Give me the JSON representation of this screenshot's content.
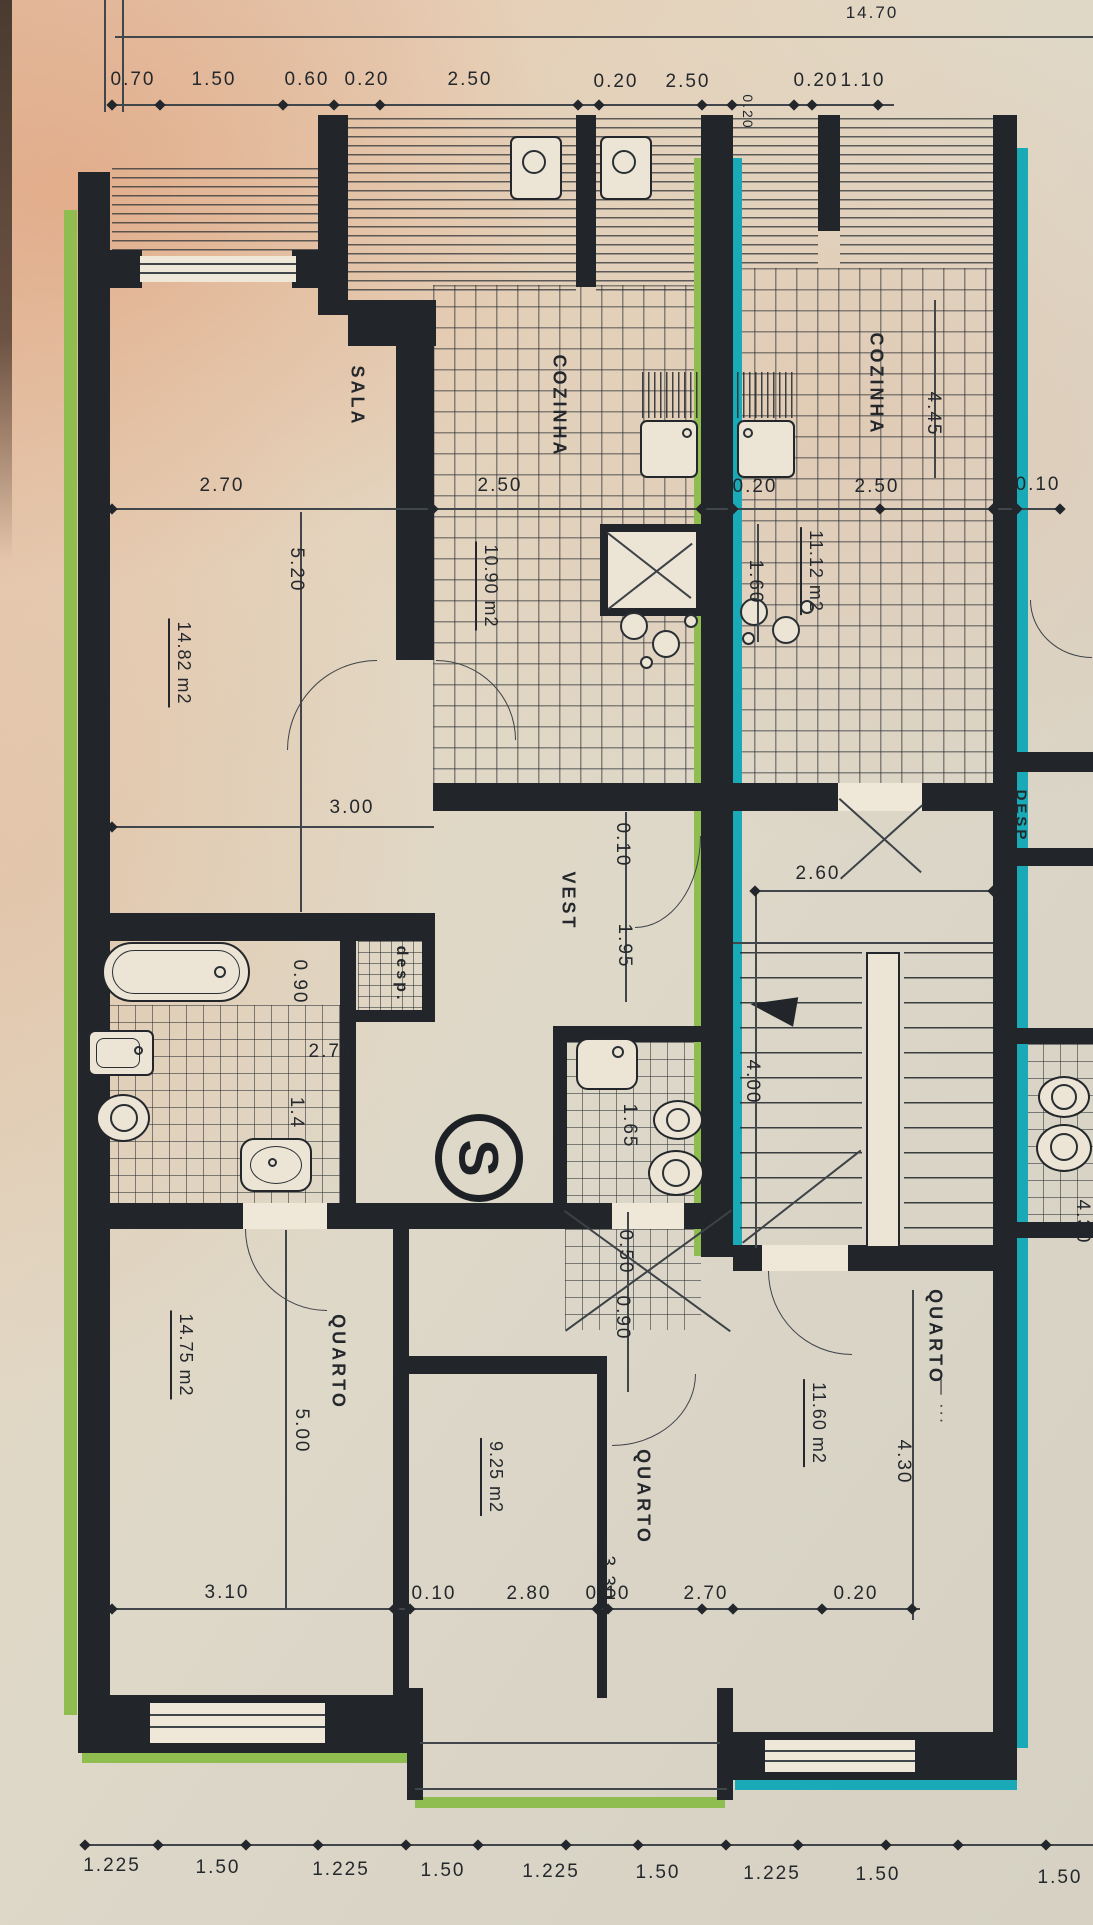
{
  "document": {
    "kind": "apartment floor plan",
    "language": "pt"
  },
  "colors": {
    "wall": "#22262a",
    "green_highlight": "#8fbd4f",
    "teal_highlight": "#1aa9b6",
    "paper_pink": "#e4c1a8",
    "paper_beige": "#ddd7c8",
    "ink": "#24282c"
  },
  "section_marker": "S",
  "labels": {
    "dimensions": [
      {
        "t": "14.70",
        "x": 872,
        "y": 13,
        "r": 0,
        "s": 17
      },
      {
        "t": "0.70",
        "x": 133,
        "y": 80,
        "r": 0
      },
      {
        "t": "1.50",
        "x": 214,
        "y": 80,
        "r": 0
      },
      {
        "t": "0.60",
        "x": 307,
        "y": 80,
        "r": 0
      },
      {
        "t": "0.20",
        "x": 367,
        "y": 80,
        "r": 0
      },
      {
        "t": "2.50",
        "x": 470,
        "y": 80,
        "r": 0
      },
      {
        "t": "0.20",
        "x": 616,
        "y": 82,
        "r": 0
      },
      {
        "t": "2.50",
        "x": 688,
        "y": 82,
        "r": 0
      },
      {
        "t": "0.20",
        "x": 816,
        "y": 81,
        "r": 0
      },
      {
        "t": "1.10",
        "x": 863,
        "y": 81,
        "r": 0
      },
      {
        "t": "0.20",
        "x": 748,
        "y": 112,
        "r": 90,
        "s": 14
      },
      {
        "t": "2.70",
        "x": 222,
        "y": 486,
        "r": 0
      },
      {
        "t": "2.50",
        "x": 500,
        "y": 486,
        "r": 0
      },
      {
        "t": "0.20",
        "x": 755,
        "y": 487,
        "r": 0
      },
      {
        "t": "2.50",
        "x": 877,
        "y": 487,
        "r": 0
      },
      {
        "t": "0.10",
        "x": 1038,
        "y": 485,
        "r": 0
      },
      {
        "t": "5.20",
        "x": 296,
        "y": 570,
        "r": 90
      },
      {
        "t": "4.45",
        "x": 933,
        "y": 414,
        "r": 90
      },
      {
        "t": "1.60",
        "x": 755,
        "y": 582,
        "r": 90
      },
      {
        "t": "3.00",
        "x": 352,
        "y": 808,
        "r": 0
      },
      {
        "t": "0.10",
        "x": 622,
        "y": 845,
        "r": 90
      },
      {
        "t": "1.95",
        "x": 624,
        "y": 946,
        "r": 90
      },
      {
        "t": "2.60",
        "x": 818,
        "y": 874,
        "r": 0
      },
      {
        "t": "4.00",
        "x": 752,
        "y": 1082,
        "r": 90
      },
      {
        "t": "0.90",
        "x": 299,
        "y": 982,
        "r": 90
      },
      {
        "t": "2.75",
        "x": 331,
        "y": 1052,
        "r": 0
      },
      {
        "t": "1.4",
        "x": 296,
        "y": 1113,
        "r": 90
      },
      {
        "t": "1.65",
        "x": 629,
        "y": 1126,
        "r": 90
      },
      {
        "t": "0.50",
        "x": 625,
        "y": 1252,
        "r": 90
      },
      {
        "t": "0.90",
        "x": 622,
        "y": 1318,
        "r": 90
      },
      {
        "t": "5.00",
        "x": 301,
        "y": 1431,
        "r": 90
      },
      {
        "t": "3.30",
        "x": 607,
        "y": 1578,
        "r": 90
      },
      {
        "t": "4.30",
        "x": 903,
        "y": 1462,
        "r": 90
      },
      {
        "t": "4.30",
        "x": 1082,
        "y": 1222,
        "r": 90
      },
      {
        "t": "3.10",
        "x": 227,
        "y": 1593,
        "r": 0
      },
      {
        "t": "0.10",
        "x": 434,
        "y": 1594,
        "r": 0
      },
      {
        "t": "2.80",
        "x": 529,
        "y": 1594,
        "r": 0
      },
      {
        "t": "0.10",
        "x": 608,
        "y": 1594,
        "r": 0
      },
      {
        "t": "2.70",
        "x": 706,
        "y": 1594,
        "r": 0
      },
      {
        "t": "0.20",
        "x": 856,
        "y": 1594,
        "r": 0
      },
      {
        "t": "1.225",
        "x": 112,
        "y": 1866,
        "r": 0
      },
      {
        "t": "1.50",
        "x": 218,
        "y": 1868,
        "r": 0
      },
      {
        "t": "1.225",
        "x": 341,
        "y": 1870,
        "r": 0
      },
      {
        "t": "1.50",
        "x": 443,
        "y": 1871,
        "r": 0
      },
      {
        "t": "1.225",
        "x": 551,
        "y": 1872,
        "r": 0
      },
      {
        "t": "1.50",
        "x": 658,
        "y": 1873,
        "r": 0
      },
      {
        "t": "1.225",
        "x": 772,
        "y": 1874,
        "r": 0
      },
      {
        "t": "1.50",
        "x": 878,
        "y": 1875,
        "r": 0
      },
      {
        "t": "1.50",
        "x": 1060,
        "y": 1878,
        "r": 0
      }
    ],
    "rooms": [
      {
        "t": "SALA",
        "x": 357,
        "y": 396,
        "r": 90
      },
      {
        "t": "COZINHA",
        "x": 559,
        "y": 406,
        "r": 90
      },
      {
        "t": "COZINHA",
        "x": 876,
        "y": 384,
        "r": 90
      },
      {
        "t": "VEST",
        "x": 568,
        "y": 901,
        "r": 90
      },
      {
        "t": "desp.",
        "x": 401,
        "y": 974,
        "r": 90,
        "s": 16
      },
      {
        "t": "QUARTO",
        "x": 338,
        "y": 1362,
        "r": 90
      },
      {
        "t": "QUARTO",
        "x": 643,
        "y": 1497,
        "r": 90
      },
      {
        "t": "QUARTO",
        "x": 935,
        "y": 1337,
        "r": 90
      },
      {
        "t": "DESP",
        "x": 1021,
        "y": 816,
        "r": 90,
        "s": 15
      }
    ],
    "areas": [
      {
        "t": "14.82 m2",
        "x": 181,
        "y": 663,
        "r": 90
      },
      {
        "t": "10.90 m2",
        "x": 488,
        "y": 586,
        "r": 90
      },
      {
        "t": "11.12 m2",
        "x": 813,
        "y": 571,
        "r": 90
      },
      {
        "t": "14.75 m2",
        "x": 183,
        "y": 1355,
        "r": 90
      },
      {
        "t": "9.25 m2",
        "x": 493,
        "y": 1477,
        "r": 90
      },
      {
        "t": "11.60 m2",
        "x": 816,
        "y": 1423,
        "r": 90
      }
    ],
    "misc": [
      {
        "t": "— ···",
        "x": 941,
        "y": 1402,
        "r": 90
      }
    ]
  }
}
